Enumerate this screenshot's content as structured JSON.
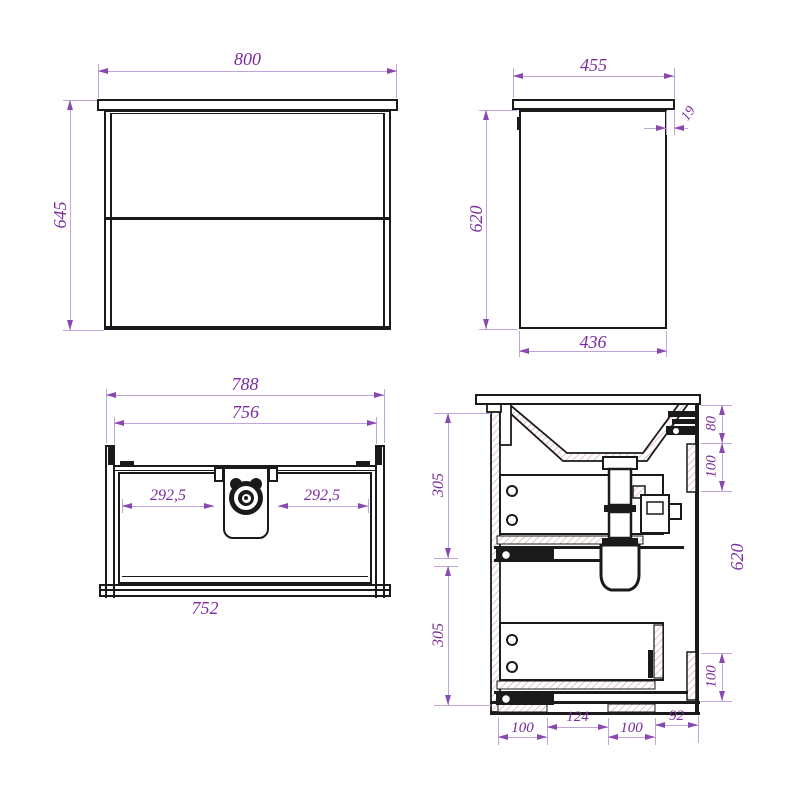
{
  "drawing": {
    "front_view": {
      "width": "800",
      "height": "645"
    },
    "side_view": {
      "top_width": "455",
      "top_overhang": "19",
      "height": "620",
      "body_width": "436"
    },
    "plan_view": {
      "outer_width": "788",
      "inner_width": "756",
      "left_to_trap": "292,5",
      "trap_to_right": "292,5",
      "bottom_width": "752"
    },
    "section_view": {
      "upper_drawer_height": "305",
      "lower_drawer_height": "305",
      "top_to_rail": "80",
      "rail_height_top": "100",
      "overall_height": "620",
      "rail_height_bottom": "100",
      "foot_left_width": "100",
      "center_gap_width": "124",
      "foot_right_width": "100",
      "right_gap_width": "92"
    }
  },
  "colors": {
    "outline": "#1a1a1a",
    "dimension_line": "#bfa5de",
    "dimension_text": "#7a2b9d",
    "hatch": "#d6a3a3"
  }
}
